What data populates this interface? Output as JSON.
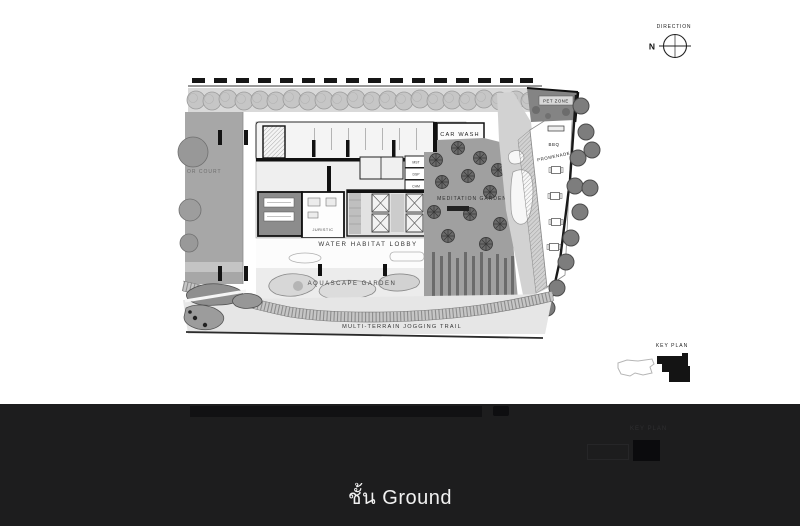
{
  "colors": {
    "page_bg": "#ffffff",
    "footer_bg": "#1d1d1e",
    "ink": "#1a1a1a",
    "garden_gray": "#a0a0a0"
  },
  "compass": {
    "label": "DIRECTION",
    "north": "N"
  },
  "key_plan": {
    "label": "KEY PLAN"
  },
  "plan": {
    "labels": {
      "court": "OR COURT",
      "car_wash_line1": "CAR WASH",
      "car_wash_line2": "AREA",
      "pet_zone": "PET ZONE",
      "bbq": "BBQ",
      "promenade": "PROMENADE",
      "meditation_garden": "MEDITATION GARDEN",
      "water_habitat_lobby": "WATER HABITAT LOBBY",
      "aquascape_garden": "AQUASCAPE GARDEN",
      "jogging_trail": "MULTI-TERRAIN JOGGING TRAIL",
      "juristic": "JURISTIC",
      "room_small_1": "MST",
      "room_small_2": "DSP",
      "room_small_3": "CHM"
    }
  },
  "footer": {
    "caption": "ชั้น Ground",
    "next_key_plan_label": "KEY PLAN"
  }
}
